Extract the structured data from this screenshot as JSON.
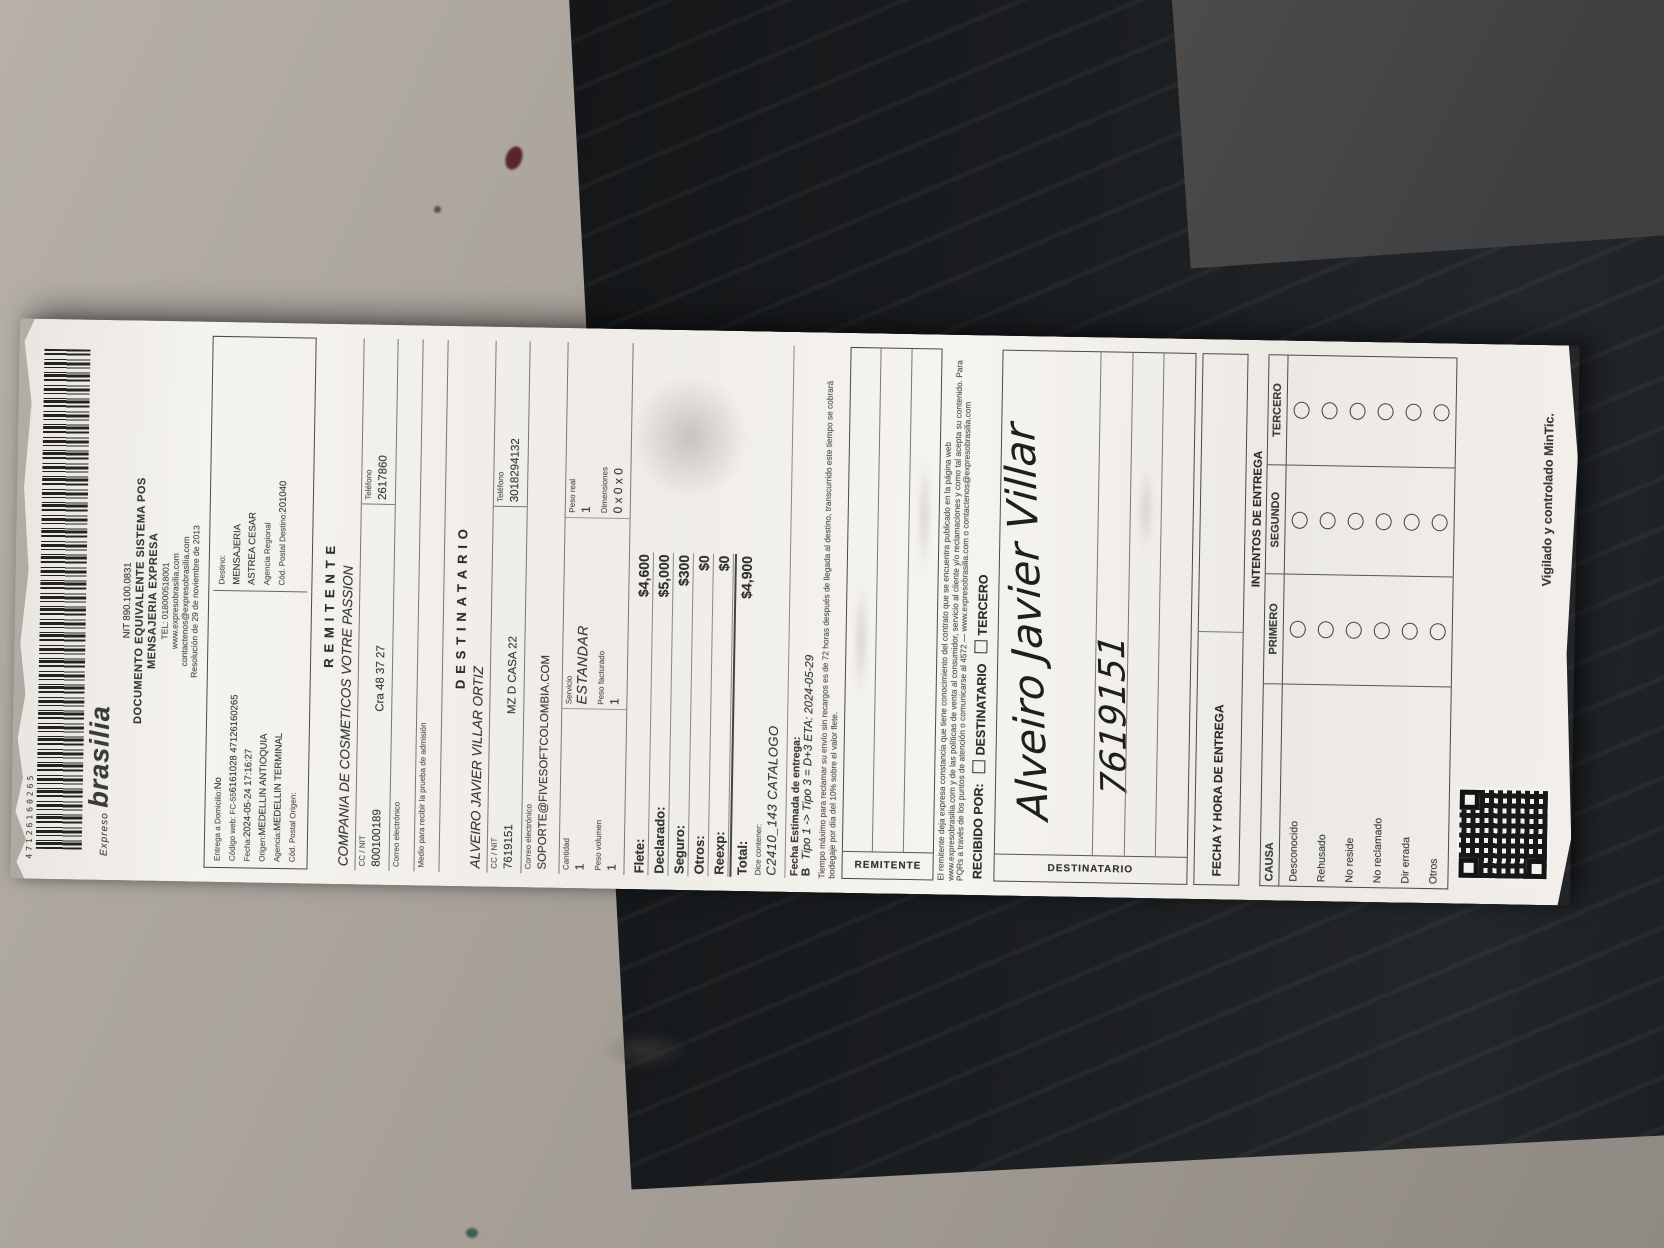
{
  "receipt": {
    "barcode_number": "47126160265",
    "logo": {
      "small": "Expreso",
      "main": "brasilia"
    },
    "header": {
      "nit": "NIT 890.100.0831",
      "doc1": "DOCUMENTO EQUIVALENTE SISTEMA POS",
      "doc2": "MENSAJERIA EXPRESA",
      "tel": "TEL: 018000518001",
      "web": "www.expresobrasilia.com",
      "mail": "contactenos@expresobrasilia.com",
      "resolucion": "Resolución de 29 de noviembre de 2013"
    },
    "admission": {
      "left": [
        {
          "label": "Entrega a Domicilio:",
          "value": "No"
        },
        {
          "label": "Código web: FC-55",
          "value": "6161028 47126160265"
        },
        {
          "label": "Fecha:",
          "value": "2024-05-24 17:16:27"
        },
        {
          "label": "Origen:",
          "value": "MEDELLIN ANTIOQUIA"
        },
        {
          "label": "Agencia:",
          "value": "MEDELLIN TERMINAL"
        },
        {
          "label": "Cód. Postal Origen:",
          "value": ""
        }
      ],
      "right": [
        {
          "label": "Destino:",
          "value": ""
        },
        {
          "label": "",
          "value": "MENSAJERIA"
        },
        {
          "label": "",
          "value": "ASTREA CESAR"
        },
        {
          "label": "Agencia Regional",
          "value": ""
        },
        {
          "label": "Cód. Postal Destino:",
          "value": "201040"
        }
      ]
    },
    "remitente": {
      "title": "REMITENTE",
      "name": "COMPANIA DE COSMETICOS VOTRE PASSION",
      "id_label": "CC / NIT",
      "id_value": "800100189",
      "address": "Cra 48 37 27",
      "phone_label": "Teléfono",
      "phone_value": "2617860",
      "email_label": "Correo electrónico",
      "proof_label": "Medio para recibir la prueba de admisión"
    },
    "destinatario": {
      "title": "DESTINATARIO",
      "name": "ALVEIRO JAVIER VILLAR ORTIZ",
      "id_label": "CC / NIT",
      "id_value": "7619151",
      "address": "MZ D CASA 22",
      "phone_label": "Teléfono",
      "phone_value": "3018294132",
      "email_label": "Correo electrónico",
      "email_value": "SOPORTE@FIVESOFTCOLOMBIA.COM"
    },
    "package": {
      "cells": [
        {
          "label": "Cantidad",
          "value": "1"
        },
        {
          "label": "Servicio",
          "value": "ESTANDAR"
        },
        {
          "label": "Peso real",
          "value": "1"
        },
        {
          "label": "Peso volumen",
          "value": "1"
        },
        {
          "label": "Peso facturado",
          "value": "1"
        },
        {
          "label": "Dimensiones",
          "value": "0 x 0 x 0"
        }
      ]
    },
    "charges": [
      {
        "label": "Flete:",
        "value": "$4,600"
      },
      {
        "label": "Declarado:",
        "value": "$5,000"
      },
      {
        "label": "Seguro:",
        "value": "$300"
      },
      {
        "label": "Otros:",
        "value": "$0"
      },
      {
        "label": "Reexp:",
        "value": "$0"
      },
      {
        "label": "Total:",
        "value": "$4,900"
      }
    ],
    "contents": {
      "label": "Dice contener:",
      "value": "C2410_143 CATALOGO"
    },
    "eta": {
      "label": "Fecha Estimada de entrega:",
      "prefix": "B",
      "value": "Tipo 1 -> Tipo 3 = D+3 ETA: 2024-05-29"
    },
    "fineprint1": "Tiempo máximo para reclamar su envío sin recargos es de 72 horas después de llegada al destino, transcurrido este tiempo se cobrará bodegaje por día del 10% sobre el valor flete.",
    "sig_remitente_label": "REMITENTE",
    "fineprint2": "El remitente deja expresa constancia que tiene conocimiento del contrato que se encuentra publicado en la página web www.expresobrasilia.com y de las políticas de venta al consumidor, servicio al cliente y/o reclamaciones y como tal acepta su contenido. Para PQRs a través de los puntos de atención o comunicarse al 4572 — www.expresobrasilia.com o contactenos@expresobrasilia.com",
    "recibido": {
      "label": "RECIBIDO POR:",
      "opt1": "DESTINATARIO",
      "opt2": "TERCERO"
    },
    "sig_destinatario_label": "DESTINATARIO",
    "handwriting": {
      "name": "Alveiro Javier Villar",
      "id": "7619151"
    },
    "fecha_entrega_label": "FECHA Y HORA DE ENTREGA",
    "intentos": {
      "title": "INTENTOS DE ENTREGA",
      "cols": [
        "CAUSA",
        "PRIMERO",
        "SEGUNDO",
        "TERCERO"
      ],
      "causas": [
        "Desconocido",
        "Rehusado",
        "No reside",
        "No reclamado",
        "Dir errada",
        "Otros"
      ]
    },
    "mintic": "Vigilado y controlado MinTic."
  }
}
